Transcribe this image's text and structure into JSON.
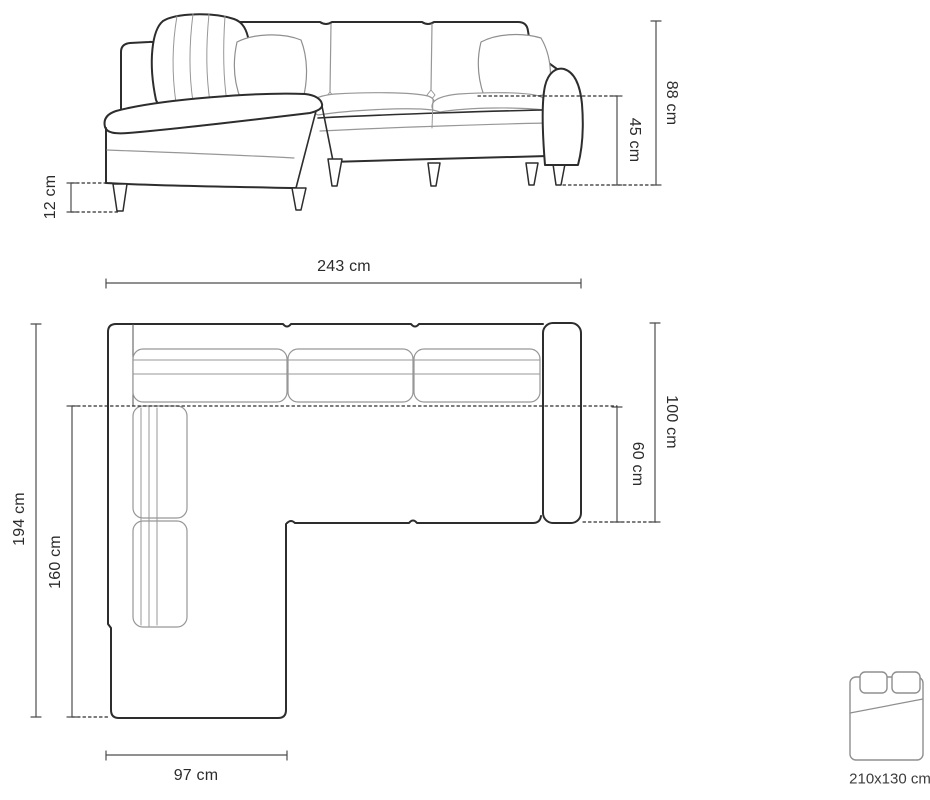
{
  "colors": {
    "outline": "#2d2d2d",
    "seam": "#979797",
    "dimension_line": "#4d4d4d",
    "text": "#2b2b2b",
    "background": "#ffffff"
  },
  "front_view": {
    "description": "corner-sofa-front-elevation",
    "dimensions": {
      "leg_height": "12 cm",
      "seat_height": "45 cm",
      "total_height": "88 cm"
    }
  },
  "top_view": {
    "description": "corner-sofa-top-plan",
    "dimensions": {
      "total_width": "243 cm",
      "total_depth": "194 cm",
      "chaise_length": "160 cm",
      "sofa_depth": "100 cm",
      "seat_depth": "60 cm",
      "chaise_width": "97 cm"
    }
  },
  "sleeping_function": {
    "icon": "bed-icon",
    "bed_size": "210x130 cm"
  }
}
